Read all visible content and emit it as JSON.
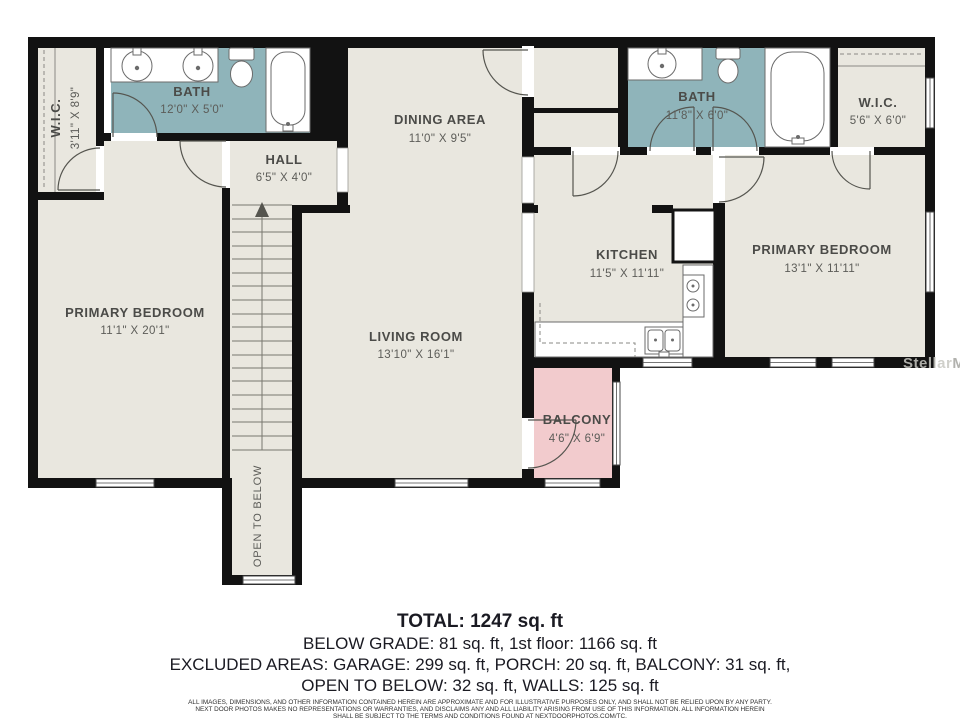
{
  "rooms": {
    "wic1": {
      "name": "W.I.C.",
      "dims": "3'11\" X 8'9\""
    },
    "bath1": {
      "name": "BATH",
      "dims": "12'0\" X 5'0\""
    },
    "hall": {
      "name": "HALL",
      "dims": "6'5\" X 4'0\""
    },
    "dining": {
      "name": "DINING AREA",
      "dims": "11'0\" X 9'5\""
    },
    "bedroom1": {
      "name": "PRIMARY BEDROOM",
      "dims": "11'1\" X 20'1\""
    },
    "living": {
      "name": "LIVING ROOM",
      "dims": "13'10\" X 16'1\""
    },
    "kitchen": {
      "name": "KITCHEN",
      "dims": "11'5\" X 11'11\""
    },
    "bath2": {
      "name": "BATH",
      "dims": "11'8\" X 6'0\""
    },
    "wic2": {
      "name": "W.I.C.",
      "dims": "5'6\" X 6'0\""
    },
    "bedroom2": {
      "name": "PRIMARY BEDROOM",
      "dims": "13'1\" X 11'11\""
    },
    "balcony": {
      "name": "BALCONY",
      "dims": "4'6\" X 6'9\""
    },
    "open_below": {
      "name": "OPEN TO BELOW"
    }
  },
  "summary": {
    "total": "TOTAL: 1247 sq. ft",
    "line2": "BELOW GRADE: 81 sq. ft, 1st floor: 1166 sq. ft",
    "line3": "EXCLUDED AREAS: GARAGE: 299 sq. ft, PORCH: 20 sq. ft, BALCONY: 31 sq. ft,",
    "line4": "OPEN TO BELOW: 32 sq. ft, WALLS: 125 sq. ft",
    "disclaimer1": "ALL IMAGES, DIMENSIONS, AND OTHER INFORMATION CONTAINED HEREIN ARE APPROXIMATE AND FOR ILLUSTRATIVE PURPOSES ONLY, AND SHALL NOT BE RELIED UPON BY ANY PARTY.",
    "disclaimer2": "NEXT DOOR PHOTOS MAKES NO REPRESENTATIONS OR WARRANTIES, AND DISCLAIMS ANY AND ALL LIABILITY ARISING FROM USE OF THIS INFORMATION. ALL INFORMATION HEREIN",
    "disclaimer3": "SHALL BE SUBJECT TO THE TERMS AND CONDITIONS FOUND AT NEXTDOORPHOTOS.COM/TC."
  },
  "watermark": {
    "part1": "Stellar",
    "part2": "MLS"
  },
  "colors": {
    "wall": "#121212",
    "room": "#e9e7df",
    "bath": "#8fb4ba",
    "balcony": "#f2cbcd",
    "text": "#1a1a22"
  }
}
